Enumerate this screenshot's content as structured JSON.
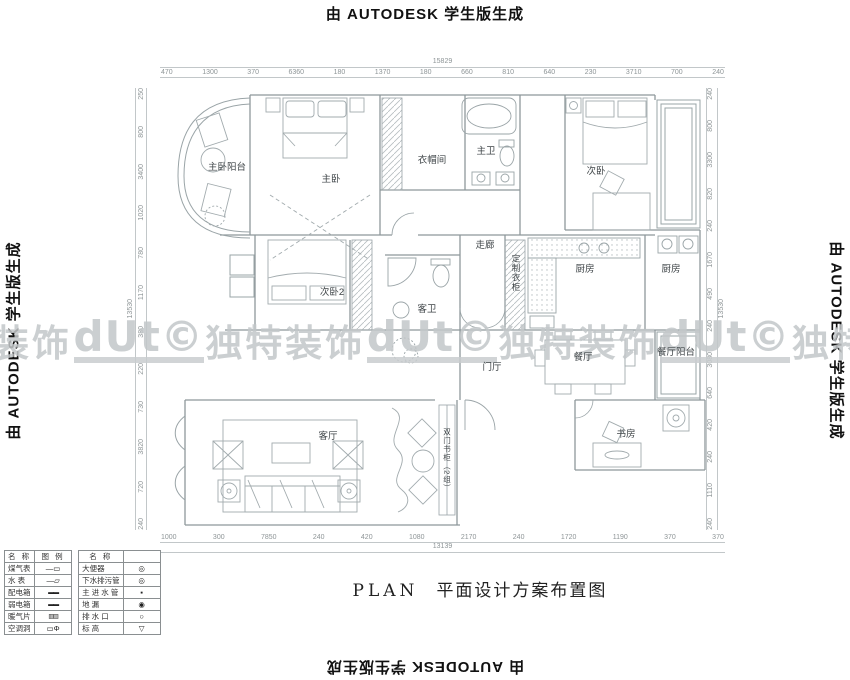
{
  "watermarks": {
    "autodesk": "由 AUTODESK 学生版生成",
    "band": [
      "装饰",
      {
        "t": "dUt©",
        "c": "logo"
      },
      "独特装饰",
      {
        "t": "dUt©",
        "c": "logo"
      },
      "独特装饰",
      {
        "t": "dUt©",
        "c": "logo"
      },
      "独特"
    ]
  },
  "title": {
    "en": "PLAN",
    "cn": "平面设计方案布置图"
  },
  "rooms": {
    "master_balcony": "主卧阳台",
    "master_bedroom": "主卧",
    "cloakroom": "衣帽间",
    "master_bath": "主卫",
    "bedroom2": "次卧",
    "corridor": "走廊",
    "custom_wardrobe": "定制衣柜",
    "kitchen": "厨房",
    "kitchen_balcony": "厨房",
    "bedroom3": "次卧2",
    "guest_bath": "客卫",
    "foyer": "门厅",
    "dining": "餐厅",
    "dining_balcony": "餐厅阳台",
    "living": "客厅",
    "bookcase": "双门书柜（2组）",
    "study": "书房"
  },
  "dimensions": {
    "top_total": "15829",
    "top": [
      "470",
      "1300",
      "370",
      "6360",
      "180",
      "1370",
      "180",
      "660",
      "810",
      "640",
      "230",
      "3710",
      "700",
      "240"
    ],
    "bottom": [
      "1000",
      "300",
      "7850",
      "240",
      "420",
      "1080",
      "2170",
      "240",
      "1720",
      "1190",
      "370",
      "370"
    ],
    "bottom_total": "13139",
    "left_total": "13530",
    "left": [
      "250",
      "800",
      "3400",
      "1020",
      "780",
      "1170",
      "380",
      "220",
      "730",
      "3820",
      "720",
      "240"
    ],
    "right": [
      "240",
      "800",
      "3300",
      "820",
      "240",
      "1670",
      "490",
      "240",
      "3080",
      "640",
      "420",
      "240",
      "1110",
      "240"
    ],
    "right_total": "13530"
  },
  "legend": {
    "header_name": "名  称",
    "header_symbol": "图  例",
    "header_name2": "名  称",
    "left_rows": [
      {
        "name": "煤气表",
        "sym": "—▭"
      },
      {
        "name": "水  表",
        "sym": "—▱"
      },
      {
        "name": "配电箱",
        "sym": "▬▬"
      },
      {
        "name": "弱电箱",
        "sym": "▬▬"
      },
      {
        "name": "暖气片",
        "sym": "▥▥"
      },
      {
        "name": "空调洞",
        "sym": "▭Φ"
      }
    ],
    "right_rows": [
      {
        "name": "大便器",
        "sym": "◎"
      },
      {
        "name": "下水排污管",
        "sym": "◎"
      },
      {
        "name": "主 进 水 管",
        "sym": "▪"
      },
      {
        "name": "地  漏",
        "sym": "◉"
      },
      {
        "name": "排 水 口",
        "sym": "○"
      },
      {
        "name": "标  高",
        "sym": "▽"
      }
    ]
  }
}
